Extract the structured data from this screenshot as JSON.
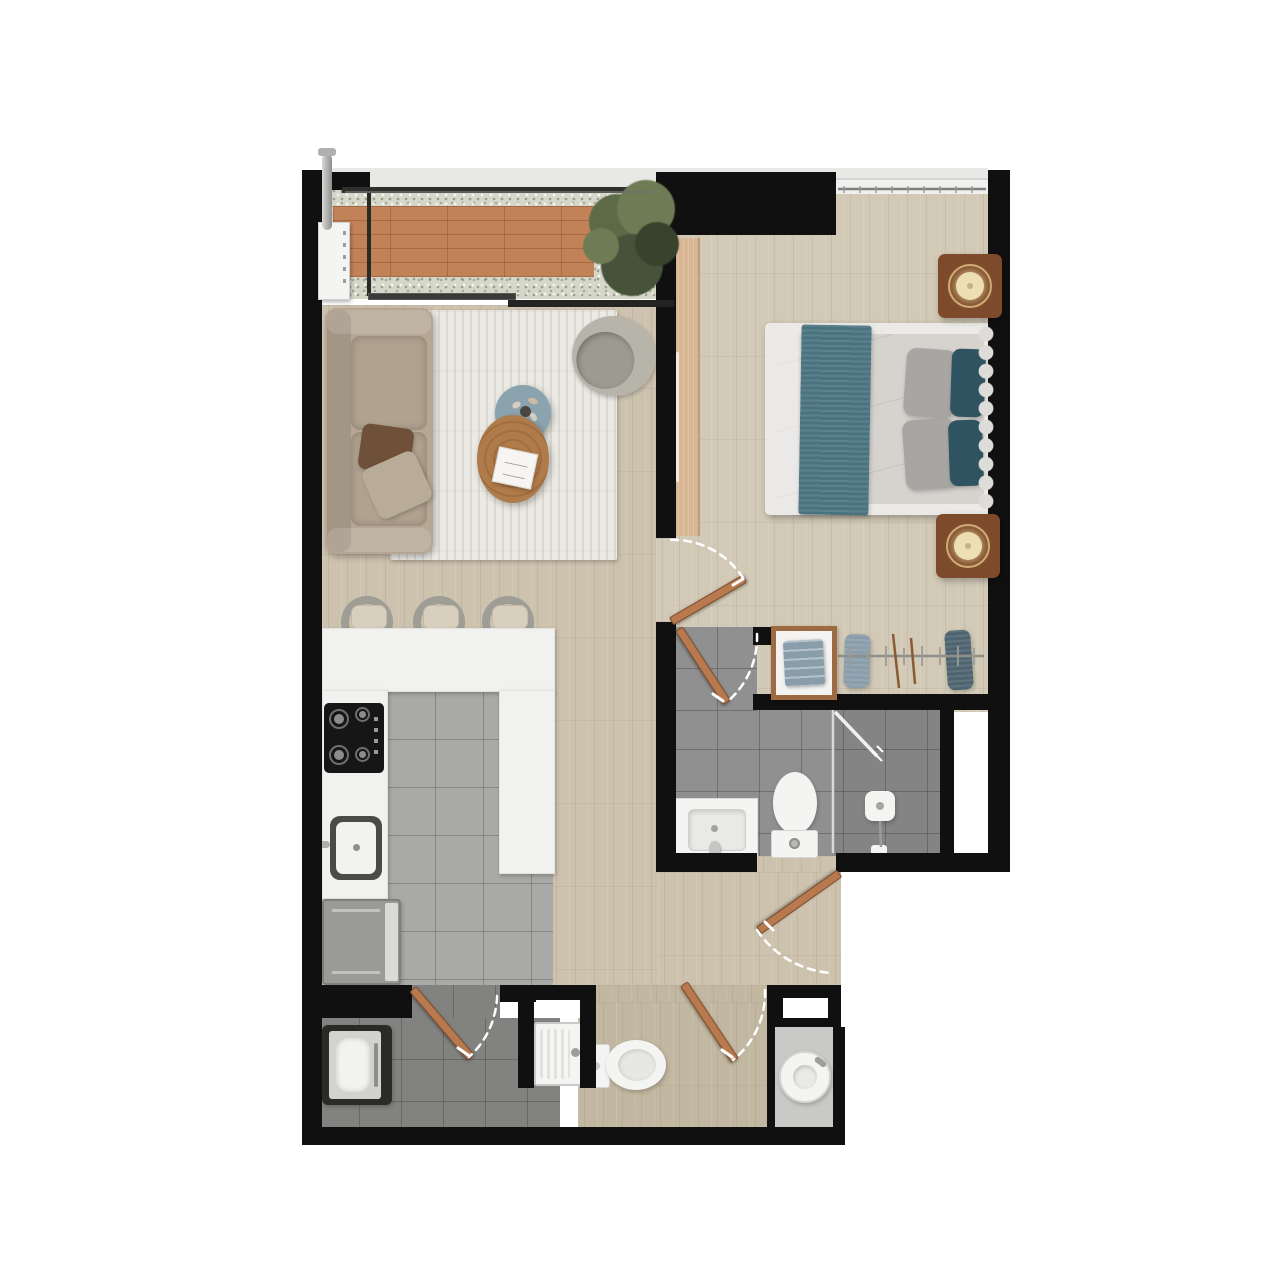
{
  "plan": {
    "kind": "one-bedroom apartment floor plan, top-down 3D render, no text labels",
    "canvas": {
      "width": 1280,
      "height": 1280,
      "background": "#ffffff"
    }
  },
  "palette": {
    "wall": "#101010",
    "sill": "#e8e8e6",
    "windowLine": "#2e2e2c",
    "woodLiving": "#cdc2ae",
    "woodBedroom": "#d2c9b6",
    "woodPowder": "#c2b7a0",
    "tileKitchen": "#a9a9a7",
    "tileBath": "#909090",
    "tileLaundry": "#828280",
    "deck": "#c28257",
    "gravel": "#d6d7c9",
    "plantDark": "#47523a",
    "plantMid": "#5d6a48",
    "plantLight": "#6e7b54",
    "rug": "#ebe9e4",
    "sofa": "#b5a794",
    "sofaCushion": "#b0a28f",
    "pillowBrown": "#6e5138",
    "pillowBeige": "#b8ab97",
    "armchairBack": "#b7b5a9",
    "armchairSeat": "#9c9b91",
    "tableBlue": "#8aa3ae",
    "tableWood": "#b07b4a",
    "book": "#f6f5f2",
    "counter": "#f1f1ef",
    "cooktop": "#161616",
    "steel": "#aeaeac",
    "fridge": "#9a9a98",
    "fridgeDoor": "#dadad8",
    "washerFrame": "#2a2a28",
    "washerBody": "#d2d2d0",
    "fixtureWhite": "#f4f4f2",
    "basin": "#e9e9e7",
    "bedFrame": "#eceae6",
    "mattress": "#d6d3cf",
    "runnerTeal": "#4a7380",
    "pillowGray": "#a8a6a2",
    "pillowTeal": "#2f5361",
    "headboard": "#d9d7d3",
    "nightstand": "#7d4b2b",
    "lampShade": "#ecdfb4",
    "wardrobePanel": "#d9b693",
    "doorLeaf": "#b9794f",
    "closetShelfFrame": "#9c6b43",
    "foldedClothes": "#8a9dab",
    "garmentTeal": "#4e6470",
    "nookCounter": "#c9c9c7",
    "duct": "#ffffff",
    "arc": "#ffffff",
    "glass": "#d8d8d6"
  },
  "rooms": [
    {
      "id": "balcony",
      "name": "Balcony",
      "floor": "terracotta plank deck with gravel border"
    },
    {
      "id": "living",
      "name": "Living Room",
      "floor": "light wood"
    },
    {
      "id": "kitchen",
      "name": "Kitchen",
      "floor": "gray tile"
    },
    {
      "id": "hallway",
      "name": "Hallway",
      "floor": "light wood"
    },
    {
      "id": "bedroom",
      "name": "Bedroom",
      "floor": "light wood"
    },
    {
      "id": "closet",
      "name": "Closet",
      "floor": "light wood"
    },
    {
      "id": "bathroom",
      "name": "Ensuite Bathroom",
      "floor": "gray tile"
    },
    {
      "id": "laundry",
      "name": "Laundry Room",
      "floor": "dark gray tile"
    },
    {
      "id": "powder",
      "name": "Toilet Room",
      "floor": "light wood"
    },
    {
      "id": "vanity-nook",
      "name": "Vanity Nook",
      "floor": "gray counter"
    }
  ],
  "furniture": {
    "balcony": [
      "wood deck",
      "gravel border",
      "potted plant",
      "water heater with chrome pipe",
      "sliding glass window"
    ],
    "living": [
      "three-seat sofa",
      "brown throw pillow",
      "beige throw pillow",
      "striped area rug",
      "shell armchair",
      "round wood coffee table",
      "round blue side table",
      "open book",
      "dried flower centerpiece"
    ],
    "kitchen": [
      "U-shaped white counter",
      "bar stool",
      "bar stool",
      "bar stool",
      "4-burner gas cooktop",
      "single-basin sink with faucet",
      "refrigerator"
    ],
    "bedroom": [
      "double bed",
      "teal bed runner",
      "2 gray pillows",
      "2 teal pillows",
      "scalloped headboard",
      "nightstand with round lamp (top)",
      "nightstand with round lamp (bottom)",
      "wardrobe sliding panel"
    ],
    "closet": [
      "shelf with folded clothes",
      "hanging rail",
      "clothes hangers",
      "hanging garment gray",
      "hanging garment teal"
    ],
    "bathroom": [
      "vanity with basin and faucet",
      "toilet",
      "glass shower screen",
      "shower door ajar",
      "shower fixture and drain"
    ],
    "laundry": [
      "top-load washing machine",
      "washboard utility sink with faucet"
    ],
    "powder": [
      "toilet"
    ],
    "vanity-nook": [
      "round vessel sink with faucet"
    ]
  },
  "openings": {
    "windows": [
      "balcony sliding window (south of balcony)",
      "balcony/living glazing strip (top)",
      "bedroom window (top)"
    ],
    "doors": [
      "bedroom swing door",
      "ensuite bathroom swing door",
      "hallway-bathroom swing door",
      "toilet room swing door",
      "laundry swing door",
      "shower glass door"
    ]
  }
}
